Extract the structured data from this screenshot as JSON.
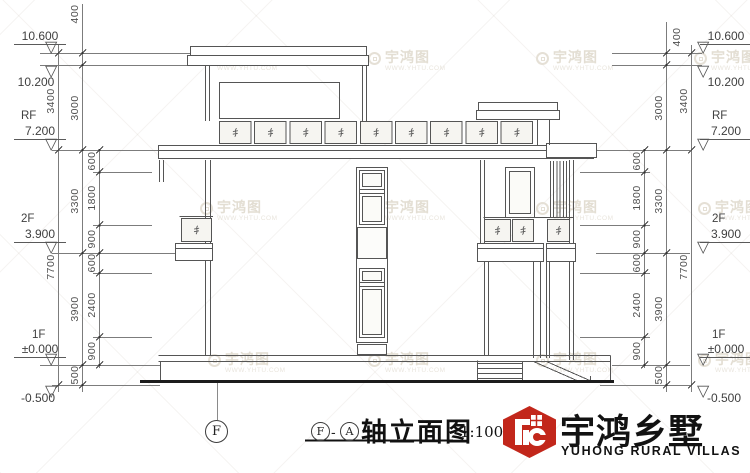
{
  "watermark": {
    "brand": "宇鸿图",
    "site": "WWW.YHTU.COM"
  },
  "icons": {
    "level_marker": "▽"
  },
  "dims": {
    "outer": [
      "3400",
      "7700"
    ],
    "mid": [
      "400",
      "3000",
      "3300",
      "3900",
      "500"
    ],
    "inner": [
      "600",
      "1800",
      "900",
      "600",
      "2400",
      "900"
    ],
    "levels": [
      {
        "prefix": "",
        "value": "10.600"
      },
      {
        "prefix": "",
        "value": "10.200"
      },
      {
        "prefix": "RF",
        "value": "7.200"
      },
      {
        "prefix": "2F",
        "value": "3.900"
      },
      {
        "prefix": "1F",
        "value": "±0.000"
      },
      {
        "prefix": "",
        "value": "-0.500"
      }
    ]
  },
  "footer": {
    "axis_bubble": "F",
    "title_bubble_start": "F",
    "title_bubble_sep": "-",
    "title_bubble_end": "A",
    "title_text": "轴立面图",
    "scale_label": "1:100"
  },
  "logo": {
    "name_cn": "宇鸿乡墅",
    "name_en": "YUHONG RURAL VILLAS"
  }
}
